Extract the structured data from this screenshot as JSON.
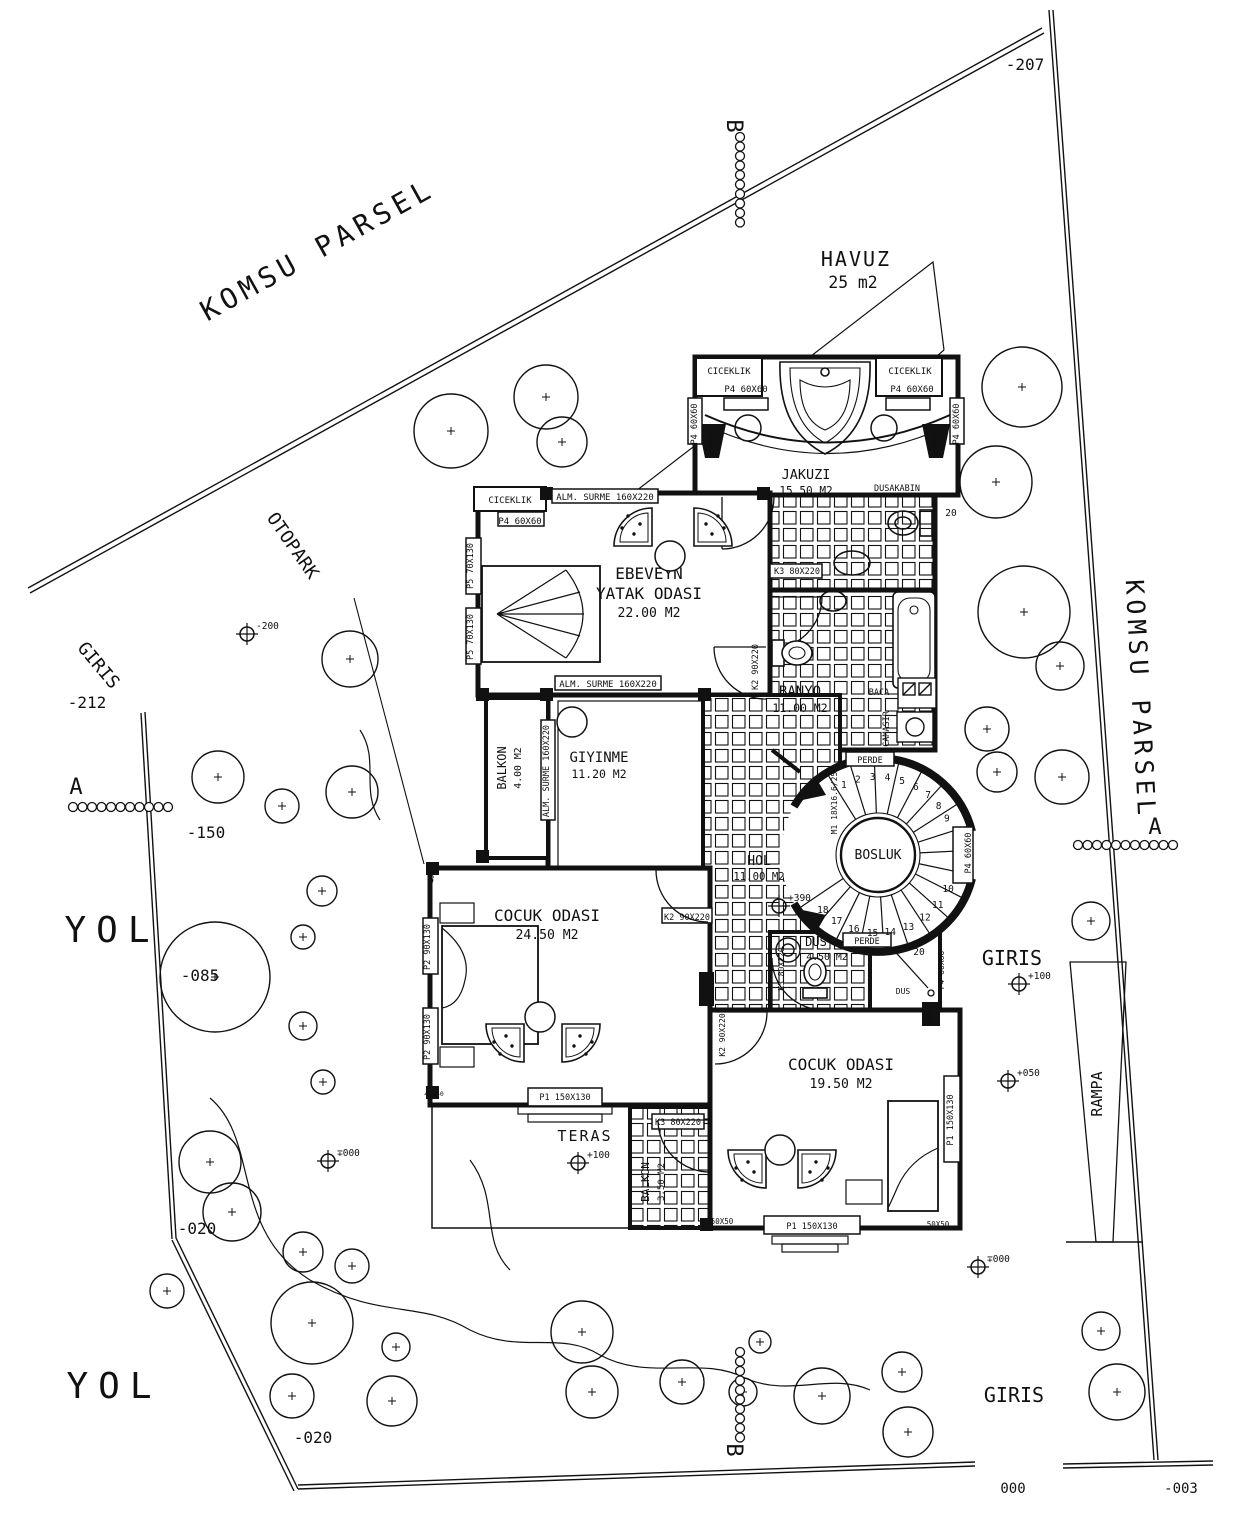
{
  "drawing": {
    "type": "villa-site-floor-plan",
    "paper": "#ffffff",
    "ink": "#111111"
  },
  "rooms": [
    {
      "n": "room-jakuzi",
      "lines": [
        "JAKUZI"
      ],
      "area": "15.50 M2",
      "x": 806,
      "y": 479,
      "s": 13.5
    },
    {
      "n": "room-ebeveyn-yatak-odasi",
      "lines": [
        "EBEVEYN",
        "YATAK ODASI"
      ],
      "area": "22.00 M2",
      "x": 649,
      "y": 579,
      "s": 16
    },
    {
      "n": "room-banyo",
      "lines": [
        "BANYO"
      ],
      "area": "11.00 M2",
      "x": 800,
      "y": 696,
      "s": 14
    },
    {
      "n": "room-giyinme",
      "lines": [
        "GIYINME"
      ],
      "area": "11.20 M2",
      "x": 599,
      "y": 762,
      "s": 14
    },
    {
      "n": "room-balkon-1",
      "lines": [
        "BALKON"
      ],
      "area": "4.00 M2",
      "x": 506,
      "y": 768,
      "ax": 521,
      "ay": 768,
      "r": -90,
      "s": 12
    },
    {
      "n": "room-hol",
      "lines": [
        "HOL"
      ],
      "area": "11.00 M2",
      "x": 759,
      "y": 865,
      "s": 13
    },
    {
      "n": "room-bosluk",
      "lines": [
        "BOSLUK"
      ],
      "x": 878,
      "y": 859,
      "s": 13
    },
    {
      "n": "room-dus",
      "lines": [
        "DUS"
      ],
      "area": "4.50 M2",
      "x": 816,
      "y": 946,
      "ax": 827,
      "ay": 960,
      "s": 12
    },
    {
      "n": "room-cocuk-odasi-1",
      "lines": [
        "COCUK ODASI"
      ],
      "area": "24.50 M2",
      "x": 547,
      "y": 921,
      "s": 16
    },
    {
      "n": "room-teras",
      "lines": [
        "TERAS"
      ],
      "x": 585,
      "y": 1141,
      "s": 15,
      "sp": 2
    },
    {
      "n": "room-balkon-2",
      "lines": [
        "BALKON"
      ],
      "area": "3.50 M2",
      "x": 649,
      "y": 1182,
      "ax": 664,
      "ay": 1182,
      "r": -90,
      "s": 11
    },
    {
      "n": "room-cocuk-odasi-2",
      "lines": [
        "COCUK ODASI"
      ],
      "area": "19.50 M2",
      "x": 841,
      "y": 1070,
      "s": 16
    },
    {
      "n": "pool-havuz",
      "lines": [
        "HAVUZ"
      ],
      "area": "25 m2",
      "x": 856,
      "y": 266,
      "ax": 853,
      "ay": 288,
      "s": 20,
      "sp": 2
    }
  ],
  "annotations": [
    {
      "n": "komsu-parsel-upper",
      "t": "KOMSU PARSEL",
      "x": 322,
      "y": 258,
      "r": -29,
      "s": 28,
      "sp": 5
    },
    {
      "n": "otopark-label",
      "t": "OTOPARK",
      "x": 288,
      "y": 549,
      "r": 55,
      "s": 18
    },
    {
      "n": "giris-left",
      "t": "GIRIS",
      "x": 94,
      "y": 669,
      "r": 50,
      "s": 18
    },
    {
      "n": "level-minus-212",
      "t": "-212",
      "x": 87,
      "y": 708,
      "s": 16
    },
    {
      "n": "level-minus-150",
      "t": "-150",
      "x": 206,
      "y": 838,
      "s": 16
    },
    {
      "n": "yol-left",
      "t": "YOL",
      "x": 112,
      "y": 942,
      "s": 36,
      "sp": 10
    },
    {
      "n": "level-minus-085",
      "t": "-085",
      "x": 200,
      "y": 981,
      "s": 16
    },
    {
      "n": "level-minus-020-left",
      "t": "-020",
      "x": 197,
      "y": 1234,
      "s": 16
    },
    {
      "n": "yol-bottom",
      "t": "YOL",
      "x": 114,
      "y": 1398,
      "s": 36,
      "sp": 10
    },
    {
      "n": "level-minus-020-bottom",
      "t": "-020",
      "x": 313,
      "y": 1443,
      "s": 16
    },
    {
      "n": "level-minus-207",
      "t": "-207",
      "x": 1025,
      "y": 70,
      "s": 16
    },
    {
      "n": "section-b-top",
      "t": "B",
      "x": 727,
      "y": 126,
      "r": 90,
      "s": 22
    },
    {
      "n": "section-b-bottom",
      "t": "B",
      "x": 727,
      "y": 1450,
      "r": 90,
      "s": 22
    },
    {
      "n": "komsu-parsel-right",
      "t": "KOMSU PARSEL",
      "x": 1132,
      "y": 700,
      "r": 87,
      "s": 25,
      "sp": 5
    },
    {
      "n": "section-a-left",
      "t": "A",
      "x": 76,
      "y": 794,
      "s": 22
    },
    {
      "n": "section-a-right",
      "t": "A",
      "x": 1155,
      "y": 834,
      "s": 22
    },
    {
      "n": "giris-right",
      "t": "GIRIS",
      "x": 1012,
      "y": 965,
      "s": 20
    },
    {
      "n": "rampa-label",
      "t": "RAMPA",
      "x": 1102,
      "y": 1094,
      "r": -90,
      "s": 15
    },
    {
      "n": "giris-bottom",
      "t": "GIRIS",
      "x": 1014,
      "y": 1402,
      "s": 20
    },
    {
      "n": "level-000",
      "t": "000",
      "x": 1013,
      "y": 1493,
      "s": 14
    },
    {
      "n": "level-minus-003",
      "t": "-003",
      "x": 1181,
      "y": 1493,
      "s": 14
    },
    {
      "n": "ciceklik-top-left",
      "t": "CICEKLIK",
      "x": 729,
      "y": 374,
      "s": 9
    },
    {
      "n": "ciceklik-top-right",
      "t": "CICEKLIK",
      "x": 910,
      "y": 374,
      "s": 9
    },
    {
      "n": "ciceklik-bedroom",
      "t": "CICEKLIK",
      "x": 510,
      "y": 503,
      "s": 9
    },
    {
      "n": "tag-p4-top-left",
      "t": "P4 60X60",
      "x": 746,
      "y": 392,
      "s": 9
    },
    {
      "n": "tag-p4-top-right",
      "t": "P4 60X60",
      "x": 912,
      "y": 392,
      "s": 9
    },
    {
      "n": "tag-p4-bedroom",
      "t": "P4 60X60",
      "x": 520,
      "y": 524,
      "s": 9
    },
    {
      "n": "tag-p4-wall-left",
      "t": "P4 60X60",
      "x": 697,
      "y": 424,
      "r": -90,
      "s": 8.5
    },
    {
      "n": "tag-p4-wall-right",
      "t": "P4 60X60",
      "x": 959,
      "y": 424,
      "r": -90,
      "s": 8.5
    },
    {
      "n": "tag-dusakabin",
      "t": "DUSAKABIN",
      "x": 897,
      "y": 491,
      "s": 8.5
    },
    {
      "n": "dim-20-top",
      "t": "20",
      "x": 951,
      "y": 516,
      "s": 9.5
    },
    {
      "n": "tag-alm-surme-top",
      "t": "ALM. SURME 160X220",
      "x": 605,
      "y": 500,
      "s": 9
    },
    {
      "n": "tag-alm-surme-mid",
      "t": "ALM. SURME 160X220",
      "x": 608,
      "y": 687,
      "s": 9
    },
    {
      "n": "tag-alm-surme-giyinme",
      "t": "ALM. SURME 160X220",
      "x": 549,
      "y": 771,
      "r": -90,
      "s": 8.5
    },
    {
      "n": "tag-p5-upper",
      "t": "P5 70X130",
      "x": 473,
      "y": 566,
      "r": -90,
      "s": 8.5
    },
    {
      "n": "tag-p5-lower",
      "t": "P5 70X130",
      "x": 473,
      "y": 637,
      "r": -90,
      "s": 8.5
    },
    {
      "n": "tag-k2-bedroom",
      "t": "K2 90X220",
      "x": 758,
      "y": 667,
      "r": -90,
      "s": 8.5
    },
    {
      "n": "tag-k3-banyo",
      "t": "K3 80X220",
      "x": 797,
      "y": 574,
      "s": 8.5
    },
    {
      "n": "tag-baca",
      "t": "BACA",
      "x": 879,
      "y": 695,
      "s": 8.5
    },
    {
      "n": "tag-camasir",
      "t": "CAMASIR",
      "x": 889,
      "y": 729,
      "r": -90,
      "s": 8.5
    },
    {
      "n": "tag-perde-top",
      "t": "PERDE",
      "x": 870,
      "y": 763,
      "s": 8.5
    },
    {
      "n": "tag-perde-bottom",
      "t": "PERDE",
      "x": 867,
      "y": 944,
      "s": 8.5
    },
    {
      "n": "tag-m1-stair",
      "t": "M1 18X16.6/25",
      "x": 837,
      "y": 803,
      "r": -90,
      "s": 8
    },
    {
      "n": "tag-p4-stair",
      "t": "P4 60X60",
      "x": 971,
      "y": 853,
      "r": -90,
      "s": 8.5
    },
    {
      "n": "tag-dus-small",
      "t": "DUS",
      "x": 903,
      "y": 994,
      "s": 8
    },
    {
      "n": "dim-20-dus",
      "t": "20",
      "x": 919,
      "y": 955,
      "s": 9.5
    },
    {
      "n": "tag-k3-dus",
      "t": "K3 80X220",
      "x": 784,
      "y": 969,
      "r": -90,
      "s": 8
    },
    {
      "n": "tag-p4-entry",
      "t": "P4 60X60",
      "x": 944,
      "y": 970,
      "r": -90,
      "s": 8
    },
    {
      "n": "tag-40x40-col-left",
      "t": "40X40",
      "x": 713,
      "y": 442,
      "r": -90,
      "s": 6.5,
      "f": "#ffffff"
    },
    {
      "n": "tag-40x40-col-right",
      "t": "40X40",
      "x": 937,
      "y": 442,
      "r": -90,
      "s": 6.5,
      "f": "#ffffff"
    },
    {
      "n": "tag-40x40-c1-bottom",
      "t": "40X40",
      "x": 434,
      "y": 1096,
      "s": 6.5,
      "f": "#ffffff"
    },
    {
      "n": "tag-40x40-c1-top",
      "t": "40X40",
      "x": 434,
      "y": 873,
      "r": -90,
      "s": 6.5,
      "f": "#ffffff"
    },
    {
      "n": "tag-40x40-entry",
      "t": "40X40",
      "x": 932,
      "y": 1014,
      "r": -90,
      "s": 6.5,
      "f": "#ffffff"
    },
    {
      "n": "tag-25x10",
      "t": "25X10",
      "x": 708,
      "y": 990,
      "r": -90,
      "s": 6,
      "f": "#ffffff"
    },
    {
      "n": "tag-k2-cocuk1",
      "t": "K2 90X220",
      "x": 687,
      "y": 920,
      "s": 8.5
    },
    {
      "n": "tag-k2-corridor",
      "t": "K2 90X220",
      "x": 725,
      "y": 1035,
      "r": -90,
      "s": 8
    },
    {
      "n": "tag-p2-upper",
      "t": "P2 90X130",
      "x": 430,
      "y": 947,
      "r": -90,
      "s": 8.5
    },
    {
      "n": "tag-p2-lower",
      "t": "P2 90X130",
      "x": 430,
      "y": 1037,
      "r": -90,
      "s": 8.5
    },
    {
      "n": "tag-p1-cocuk1",
      "t": "P1 150X130",
      "x": 565,
      "y": 1100,
      "s": 8.5
    },
    {
      "n": "tag-p1-cocuk2-right",
      "t": "P1 150X130",
      "x": 953,
      "y": 1120,
      "r": -90,
      "s": 8.5
    },
    {
      "n": "tag-p1-cocuk2-bottom",
      "t": "P1 150X130",
      "x": 812,
      "y": 1229,
      "s": 8.5
    },
    {
      "n": "tag-50x50-left",
      "t": "50X50",
      "x": 722,
      "y": 1224,
      "s": 7.5
    },
    {
      "n": "tag-50x50-right",
      "t": "50X50",
      "x": 938,
      "y": 1227,
      "s": 7.5
    },
    {
      "n": "tag-k3-balkon2",
      "t": "K3 80X220",
      "x": 678,
      "y": 1125,
      "s": 8.5
    }
  ],
  "elevation_markers": [
    {
      "n": "marker-minus-200",
      "t": "-200",
      "x": 247,
      "y": 634
    },
    {
      "n": "marker-plus-390",
      "t": "+390",
      "x": 779,
      "y": 906
    },
    {
      "n": "marker-plus-100-teras",
      "t": "+100",
      "x": 578,
      "y": 1163
    },
    {
      "n": "marker-plus-100-giris",
      "t": "+100",
      "x": 1019,
      "y": 984
    },
    {
      "n": "marker-plus-050",
      "t": "+050",
      "x": 1008,
      "y": 1081
    },
    {
      "n": "marker-000-left",
      "t": "∓000",
      "x": 328,
      "y": 1161
    },
    {
      "n": "marker-000-right",
      "t": "∓000",
      "x": 978,
      "y": 1267
    }
  ],
  "section_chains": [
    {
      "n": "section-b-top-chain",
      "x": 740,
      "y": 137,
      "dx": 0,
      "dy": 9.5,
      "count": 10
    },
    {
      "n": "section-b-bottom-chain",
      "x": 740,
      "y": 1352,
      "dx": 0,
      "dy": 9.5,
      "count": 10
    },
    {
      "n": "section-a-left-chain",
      "x": 73,
      "y": 807,
      "dx": 9.5,
      "dy": 0,
      "count": 11
    },
    {
      "n": "section-a-right-chain",
      "x": 1078,
      "y": 845,
      "dx": 9.5,
      "dy": 0,
      "count": 11
    }
  ],
  "stair": {
    "cx": 878,
    "cy": 855,
    "r_outer": 97,
    "r_inner": 37,
    "r_numbers": 78,
    "line_angle_start": 122,
    "line_angle_end": -146,
    "line_count": 19,
    "numbers": [
      "1",
      "2",
      "3",
      "4",
      "5",
      "6",
      "7",
      "8",
      "9",
      "10",
      "11",
      "12",
      "13",
      "14",
      "15",
      "16",
      "17",
      "18"
    ],
    "number_angles": [
      116,
      105,
      94,
      83,
      72,
      61,
      50,
      39,
      28,
      -26,
      -40,
      -53,
      -67,
      -81,
      -94,
      -108,
      -122,
      -135
    ]
  },
  "furniture": {
    "chairs": [
      [
        630,
        522,
        0,
        1
      ],
      [
        716,
        522,
        0,
        0
      ],
      [
        502,
        1048,
        180,
        0
      ],
      [
        584,
        1048,
        180,
        1
      ],
      [
        744,
        1174,
        180,
        0
      ],
      [
        820,
        1174,
        180,
        1
      ]
    ],
    "tables": [
      [
        670,
        556
      ],
      [
        572,
        722
      ],
      [
        540,
        1017
      ],
      [
        780,
        1150
      ]
    ]
  },
  "trees": [
    [
      451,
      431,
      37
    ],
    [
      546,
      397,
      32
    ],
    [
      562,
      442,
      25
    ],
    [
      1022,
      387,
      40
    ],
    [
      996,
      482,
      36
    ],
    [
      1024,
      612,
      46
    ],
    [
      1060,
      666,
      24
    ],
    [
      987,
      729,
      22
    ],
    [
      997,
      772,
      20
    ],
    [
      1062,
      777,
      27
    ],
    [
      1091,
      921,
      19
    ],
    [
      350,
      659,
      28
    ],
    [
      218,
      777,
      26
    ],
    [
      282,
      806,
      17
    ],
    [
      352,
      792,
      26
    ],
    [
      322,
      891,
      15
    ],
    [
      303,
      937,
      12
    ],
    [
      215,
      977,
      55
    ],
    [
      303,
      1026,
      14
    ],
    [
      323,
      1082,
      12
    ],
    [
      210,
      1162,
      31
    ],
    [
      232,
      1212,
      29
    ],
    [
      303,
      1252,
      20
    ],
    [
      167,
      1291,
      17
    ],
    [
      352,
      1266,
      17
    ],
    [
      312,
      1323,
      41
    ],
    [
      396,
      1347,
      14
    ],
    [
      292,
      1396,
      22
    ],
    [
      392,
      1401,
      25
    ],
    [
      582,
      1332,
      31
    ],
    [
      592,
      1392,
      26
    ],
    [
      682,
      1382,
      22
    ],
    [
      743,
      1392,
      14
    ],
    [
      822,
      1396,
      28
    ],
    [
      902,
      1372,
      20
    ],
    [
      908,
      1432,
      25
    ],
    [
      1101,
      1331,
      19
    ],
    [
      1117,
      1392,
      28
    ],
    [
      760,
      1342,
      11
    ]
  ]
}
